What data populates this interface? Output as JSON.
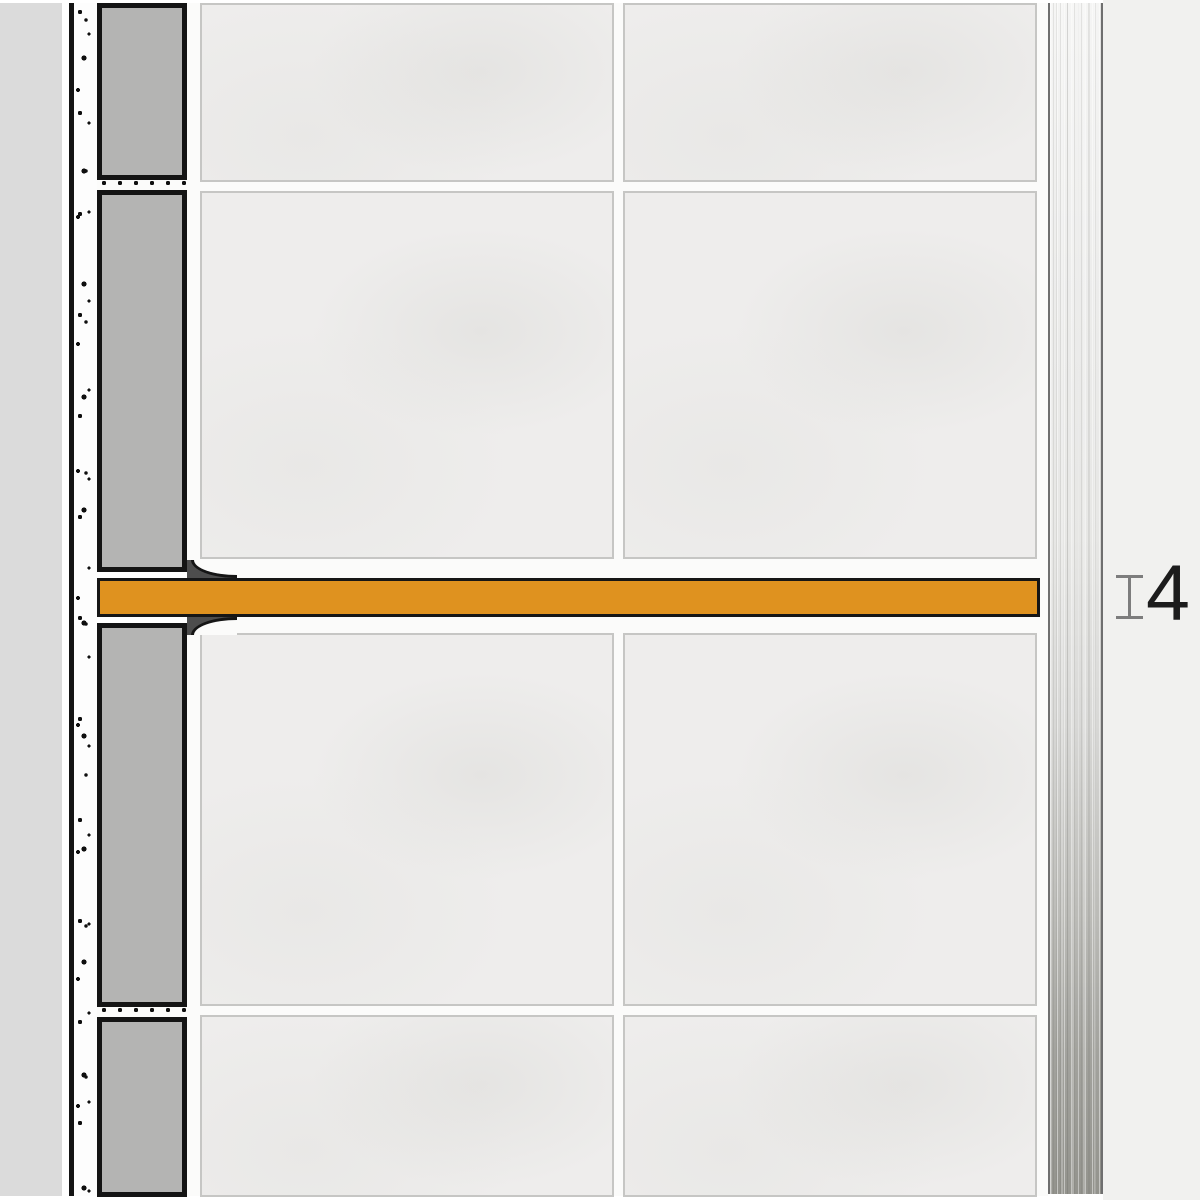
{
  "dimension": {
    "label": "4"
  },
  "icons": {
    "dimension_extent": "dimension-extent-icon (i-beam css shape)"
  },
  "colors": {
    "background_right": "#f1f1ef",
    "wall_substrate": "#dbdbdb",
    "outline": "#141414",
    "mortar_white": "#fdfdfd",
    "tile_section_gray": "#b4b4b3",
    "tile_face": "#eeedec",
    "tile_edge": "#c6c6c4",
    "grout_white": "#fbfbfa",
    "profile_orange": "#df921f",
    "adhesive_dark": "#4d4d4d",
    "steel_border": "#6f6f6f",
    "steel_light": "#f5f5f4",
    "steel_dark": "#93938d",
    "dimension_marker_gray": "#7d7d7d",
    "dimension_text": "#1c1c1c"
  }
}
